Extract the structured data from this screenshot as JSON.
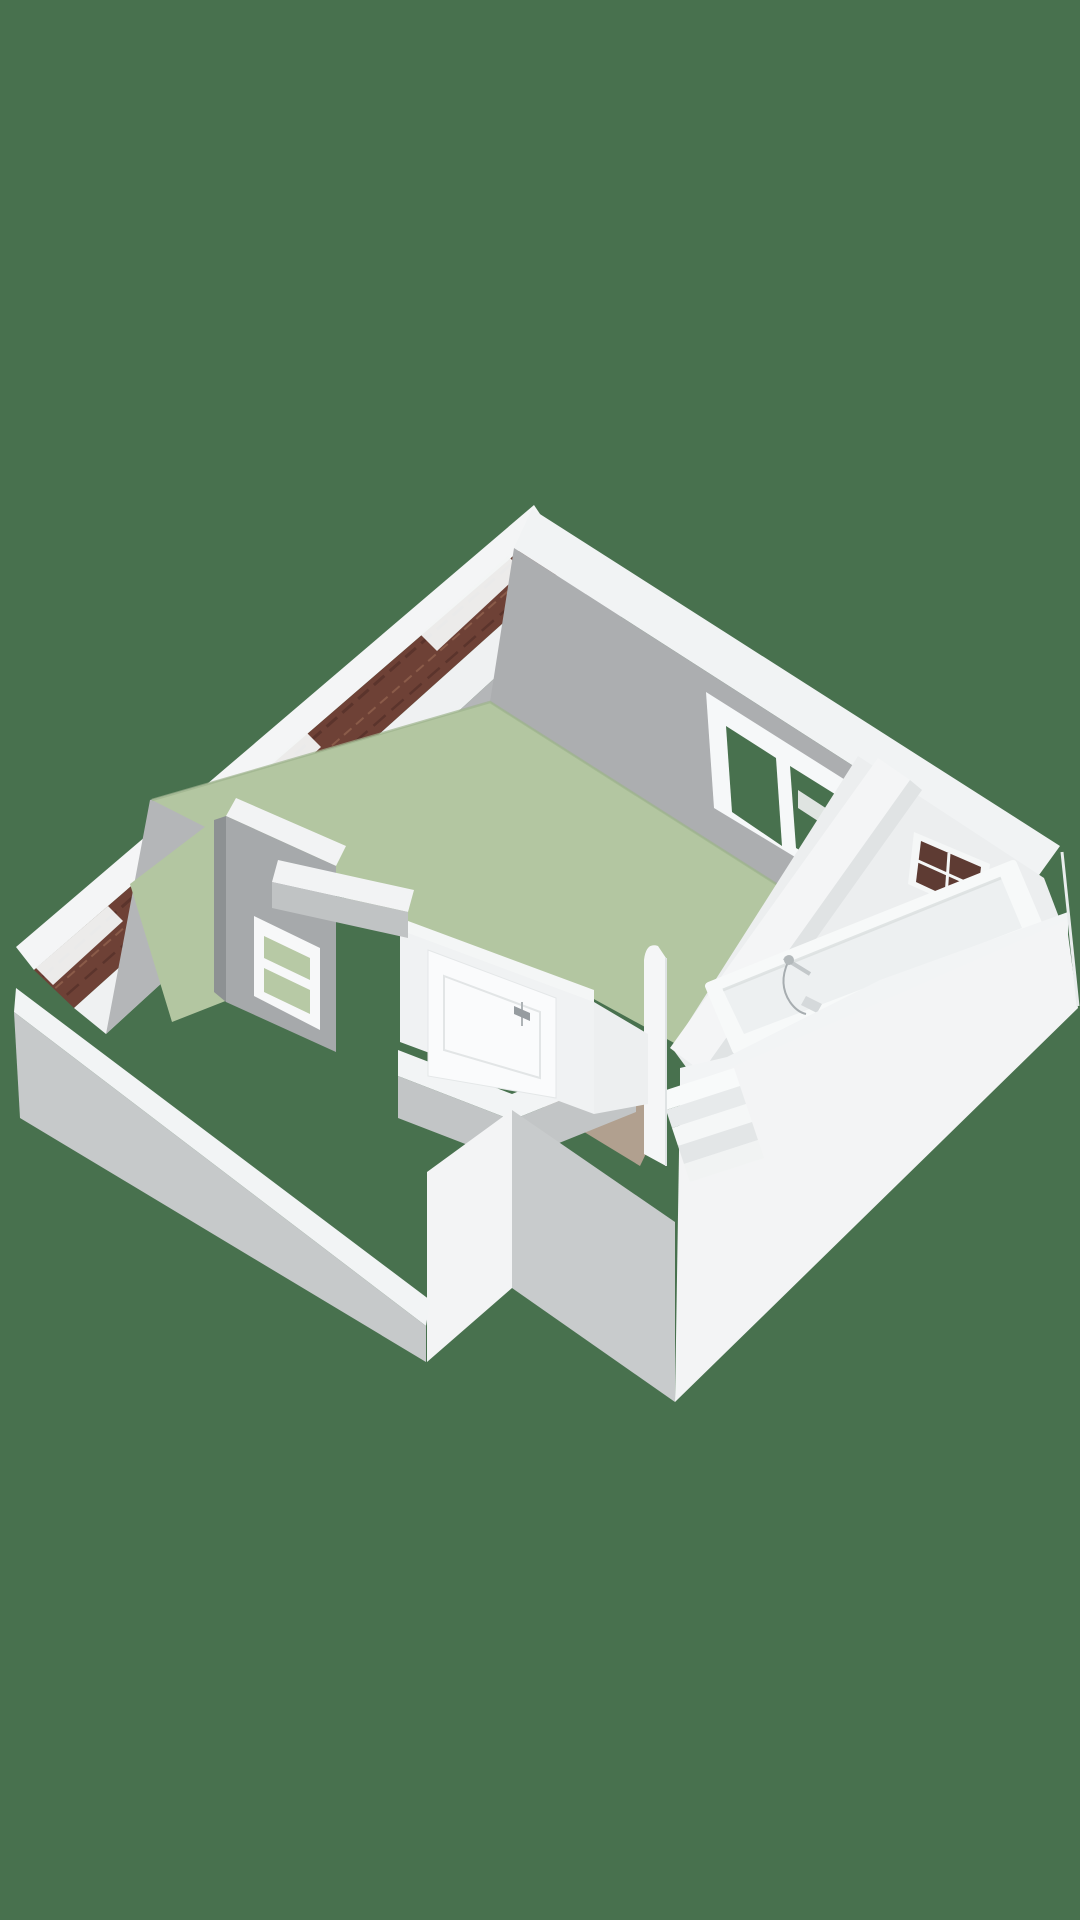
{
  "meta": {
    "title": "3D floor plan render - attic storey cutaway",
    "projection": "isometric-perspective dollhouse view",
    "background_color": "#48714E"
  },
  "colors": {
    "background": "#48714E",
    "bedroom_floor": "#B3C6A1",
    "floor_edge_shade": "#9EB38D",
    "hall_floor": "#B1A08F",
    "wall_white": "#F2F4F5",
    "wall_inner_gray": "#ACAEB0",
    "wall_outer_gray": "#C6C9CA",
    "roof_brick": "#6E4136",
    "roof_brick_dark": "#5B342C",
    "roof_brick_light": "#8A5B49",
    "fixture_white": "#F7F9F9",
    "fixture_inner": "#EDF0F1",
    "glass_exterior": "#48714E",
    "glass_interior_green": "#B7C9A5",
    "glass_dark_window": "#5E3B33",
    "chrome": "#A7ADB0"
  },
  "rooms": [
    {
      "id": "bedroom",
      "floor": "sage-green",
      "features": [
        "gable roof edge",
        "casement window",
        "interior borrowed-light window",
        "white panel door"
      ]
    },
    {
      "id": "bathroom",
      "floor": "light",
      "features": [
        "bathtub",
        "wall faucet with hand shower",
        "toilet",
        "small gridded window"
      ]
    },
    {
      "id": "hallway-landing",
      "floor": "tan",
      "features": [
        "door to bedroom",
        "stair opening"
      ]
    },
    {
      "id": "stairwell",
      "floor": "white steps",
      "features": [
        "winding stairs",
        "curved stair wall"
      ]
    }
  ],
  "scene": {
    "width": 1080,
    "height": 1920,
    "items": [
      {
        "n": "roof-ridge-band",
        "t": "p",
        "pts": "534,505 16,947 34,970 548,526",
        "f": "#F4F5F6"
      },
      {
        "n": "roof-brick-strip",
        "t": "p",
        "pts": "548,526 34,970 74,1008 580,554",
        "f": "#6E4136"
      },
      {
        "n": "roof-brick-row-line-1",
        "t": "pl",
        "pts": "542,537 40,979",
        "s": "#5B342C",
        "sw": 3,
        "dash": "14,7"
      },
      {
        "n": "roof-brick-row-line-2",
        "t": "pl",
        "pts": "556,549 52,991",
        "s": "#8A5B49",
        "sw": 2,
        "dash": "10,6"
      },
      {
        "n": "roof-brick-row-line-3",
        "t": "pl",
        "pts": "566,557 62,999",
        "s": "#5B342C",
        "sw": 2.5,
        "dash": "16,8"
      },
      {
        "n": "roof-flashing-1",
        "t": "p",
        "pts": "508,556 420,634 437,651 523,571",
        "f": "#F2F4F4",
        "o": 0.95
      },
      {
        "n": "roof-flashing-2",
        "t": "p",
        "pts": "306,732 218,810 235,827 321,747",
        "f": "#F2F4F4",
        "o": 0.95
      },
      {
        "n": "roof-flashing-3",
        "t": "p",
        "pts": "108,906 36,968 53,985 123,921",
        "f": "#F2F4F4",
        "o": 0.95
      },
      {
        "n": "gable-wall-top-band",
        "t": "p",
        "pts": "580,554 74,1008 106,1034 604,578",
        "f": "#EFF1F2"
      },
      {
        "n": "gable-wall-inner-face",
        "t": "p",
        "pts": "604,578 640,660 150,800 106,1034",
        "f": "#B4B6B8"
      },
      {
        "n": "ne-wall-top-band",
        "t": "p",
        "pts": "532,509 1060,846 1034,882 514,548",
        "f": "#F1F3F4"
      },
      {
        "n": "ne-wall-inner-face",
        "t": "p",
        "pts": "514,548 1034,882 992,934 858,936 490,702",
        "f": "#ACAEB0"
      },
      {
        "n": "bedroom-floor",
        "t": "p",
        "pts": "490,702 858,936 676,1044 592,998 404,928 286,868 152,800",
        "f": "#B3C6A1"
      },
      {
        "n": "bedroom-floor-edge-shadow",
        "t": "pl",
        "pts": "152,800 490,702 858,936",
        "s": "#9EB38D",
        "sw": 2.5,
        "o": 0.7
      },
      {
        "n": "bedroom-floor-west-sliver",
        "t": "p",
        "pts": "214,820 228,1000 172,1022 130,884",
        "f": "#B3C6A1"
      },
      {
        "n": "storage-wall-top-band",
        "t": "p",
        "pts": "236,798 346,846 336,866 226,816",
        "f": "#F2F3F4"
      },
      {
        "n": "storage-wall-face",
        "t": "p",
        "pts": "226,816 336,866 336,1052 226,1002",
        "f": "#A6A9AB"
      },
      {
        "n": "storage-wall-edge",
        "t": "p",
        "pts": "214,820 226,816 226,1002 214,992",
        "f": "#8D9193"
      },
      {
        "n": "interior-window-frame",
        "t": "p",
        "pts": "254,916 320,948 320,1030 254,996",
        "f": "#F7F8F9"
      },
      {
        "n": "interior-window-pane-upper",
        "t": "p",
        "pts": "264,936 310,958 310,980 264,958",
        "f": "#B7C9A5"
      },
      {
        "n": "interior-window-pane-lower",
        "t": "p",
        "pts": "264,968 310,990 310,1014 264,992",
        "f": "#B7C9A5"
      },
      {
        "n": "bedroom-window-frame",
        "t": "p",
        "pts": "706,692 858,788 866,900 714,808",
        "f": "#F6F8F9"
      },
      {
        "n": "bedroom-window-pane-left",
        "t": "p",
        "pts": "726,726 776,758 782,846 732,812",
        "f": "#48714E"
      },
      {
        "n": "bedroom-window-pane-right",
        "t": "p",
        "pts": "790,766 838,796 844,876 796,848",
        "f": "#48714E"
      },
      {
        "n": "bedroom-window-through-wall-band",
        "t": "p",
        "pts": "798,790 838,816 838,834 798,808",
        "f": "#EFF1F2",
        "o": 0.9
      },
      {
        "n": "bathroom-interior",
        "t": "p",
        "pts": "858,756 1044,878 1060,920 992,952 700,1086 672,1048",
        "f": "#ECEEEF"
      },
      {
        "n": "bathroom-window-frame",
        "t": "p",
        "pts": "914,832 990,864 984,918 908,884",
        "f": "#F5F7F7"
      },
      {
        "n": "bathroom-window-glass",
        "t": "p",
        "pts": "921,841 981,867 976,910 916,882",
        "f": "#5E3B33"
      },
      {
        "n": "bathroom-window-bar-horizontal",
        "t": "pl",
        "pts": "918,861 978,888",
        "s": "#F5F7F7",
        "sw": 3
      },
      {
        "n": "bathroom-window-bar-vertical",
        "t": "pl",
        "pts": "949,853 946,897",
        "s": "#F5F7F7",
        "sw": 3
      },
      {
        "n": "toilet-tank",
        "t": "p",
        "pts": "716,1022 764,1002 778,1028 730,1048",
        "f": "#F4F6F6"
      },
      {
        "n": "toilet-tank-inner",
        "t": "p",
        "pts": "724,1024 758,1010 766,1026 732,1040",
        "f": "#DFE3E4"
      },
      {
        "n": "toilet-bowl",
        "t": "p",
        "pts": "692,1040 734,1022 750,1046 708,1066",
        "f": "#F7F9F9",
        "s": "#F7F9F9",
        "sw": 6,
        "rj": 1
      },
      {
        "n": "toilet-bowl-inner",
        "t": "p",
        "pts": "704,1044 732,1032 740,1048 712,1060",
        "f": "#DDE1E2"
      },
      {
        "n": "partition-wall-top-band",
        "t": "p",
        "pts": "878,758 910,780 702,1072 670,1048",
        "f": "#F4F5F6"
      },
      {
        "n": "partition-wall-shade",
        "t": "p",
        "pts": "910,780 922,790 714,1082 702,1072",
        "f": "#E0E3E4"
      },
      {
        "n": "bathtub-rim",
        "t": "p",
        "pts": "709,986 1013,864 1040,928 736,1050",
        "f": "#F7F9F9",
        "s": "#F7F9F9",
        "sw": 8,
        "rj": 1
      },
      {
        "n": "bathtub-basin",
        "t": "p",
        "pts": "723,990 1001,878 1022,928 744,1034",
        "f": "#EDF0F1"
      },
      {
        "n": "bathtub-basin-shadow",
        "t": "pl",
        "pts": "723,990 1001,878",
        "s": "#D9DEDF",
        "sw": 3,
        "o": 0.8
      },
      {
        "n": "faucet-bar",
        "t": "pl",
        "pts": "784,958 810,974",
        "s": "#C3C8CA",
        "sw": 4
      },
      {
        "n": "faucet-hose",
        "t": "pa",
        "d": "M788,962 Q778,984 790,1002 Q797,1012 806,1014",
        "s": "#A7ADB0",
        "sw": 2,
        "f": "none"
      },
      {
        "n": "shower-head",
        "t": "e",
        "cx": 789,
        "cy": 960,
        "rx": 5,
        "ry": 5,
        "f": "#B3B9BB"
      },
      {
        "n": "faucet-spout",
        "t": "p",
        "pts": "806,996 822,1004 817,1013 801,1005",
        "f": "#D5D9DB"
      },
      {
        "n": "se-wall-top-band",
        "t": "p",
        "pts": "1068,912 880,980 727,1057 680,1068 680,1096 727,1085 880,1008 1068,938",
        "f": "#F2F4F5"
      },
      {
        "n": "se-outer-wall-face",
        "t": "p",
        "pts": "1066,920 1078,1008 675,1402 680,1090",
        "f": "#F3F4F5"
      },
      {
        "n": "se-corner-arris",
        "t": "pl",
        "pts": "1062,852 1078,1006",
        "s": "#E9ECED",
        "sw": 3
      },
      {
        "n": "hall-floor",
        "t": "p",
        "pts": "545,1040 668,1108 640,1166 535,1102",
        "f": "#B1A08F"
      },
      {
        "n": "hall-floor-door-sliver",
        "t": "p",
        "pts": "416,1086 450,1102 438,1130 408,1114",
        "f": "#B1A08F"
      },
      {
        "n": "stair-step-1",
        "t": "p",
        "pts": "660,1092 734,1068 740,1086 666,1110",
        "f": "#F8FAFA"
      },
      {
        "n": "stair-step-2",
        "t": "p",
        "pts": "666,1110 740,1086 746,1104 672,1128",
        "f": "#E7EAEB"
      },
      {
        "n": "stair-step-3",
        "t": "p",
        "pts": "672,1128 746,1104 752,1122 678,1146",
        "f": "#F5F7F7"
      },
      {
        "n": "stair-step-4",
        "t": "p",
        "pts": "678,1146 752,1122 758,1140 684,1164",
        "f": "#E3E6E7"
      },
      {
        "n": "stair-step-5",
        "t": "p",
        "pts": "684,1164 758,1140 764,1158 690,1182",
        "f": "#F1F3F3"
      },
      {
        "n": "stairwell-curved-wall",
        "t": "pa",
        "d": "M644,1154 L644,960 Q646,942 658,946 L666,958 L666,1166 Z",
        "f": "#F5F6F7"
      },
      {
        "n": "stairwell-curved-wall-edge",
        "t": "pl",
        "pts": "666,958 666,1166",
        "s": "#DFE3E4",
        "sw": 2
      },
      {
        "n": "front-notch-band-left",
        "t": "p",
        "pts": "398,1050 512,1094 512,1120 398,1076",
        "f": "#F2F4F5"
      },
      {
        "n": "front-notch-band-right",
        "t": "p",
        "pts": "512,1094 636,1044 636,1070 512,1120",
        "f": "#F2F4F5"
      },
      {
        "n": "front-notch-underface-left",
        "t": "p",
        "pts": "398,1076 512,1120 512,1162 398,1118",
        "f": "#C2C5C6"
      },
      {
        "n": "front-notch-underface-right",
        "t": "p",
        "pts": "512,1120 636,1070 636,1112 512,1162",
        "f": "#C2C5C6"
      },
      {
        "n": "notch-white-face",
        "t": "p",
        "pts": "427,1172 512,1110 512,1288 427,1362",
        "f": "#F3F4F5"
      },
      {
        "n": "stairwell-bump-gray-face",
        "t": "p",
        "pts": "512,1110 675,1222 675,1402 512,1288",
        "f": "#C8CBCC"
      },
      {
        "n": "sw-wall-top-band",
        "t": "p",
        "pts": "16,988 430,1300 426,1326 14,1012",
        "f": "#F2F4F5"
      },
      {
        "n": "sw-outer-wall-face",
        "t": "p",
        "pts": "14,1012 426,1326 426,1362 20,1118",
        "f": "#C6C9CA"
      },
      {
        "n": "doorwall-top-band",
        "t": "p",
        "pts": "400,918 594,990 594,1004 400,932",
        "f": "#F4F6F6"
      },
      {
        "n": "door-wall",
        "t": "p",
        "pts": "400,930 594,1002 594,1114 400,1042",
        "f": "#F0F2F3"
      },
      {
        "n": "bedroom-door",
        "t": "p",
        "pts": "428,950 556,998 556,1098 428,1076",
        "f": "#FAFBFC",
        "s": "#E4E7E8",
        "sw": 1
      },
      {
        "n": "bedroom-door-panel",
        "t": "p",
        "pts": "444,976 540,1012 540,1078 444,1050",
        "f": "none",
        "s": "#E2E5E6",
        "sw": 2
      },
      {
        "n": "door-handle-plate",
        "t": "pl",
        "pts": "522,1002 522,1026",
        "s": "#AEB3B6",
        "sw": 2
      },
      {
        "n": "door-handle",
        "t": "p",
        "pts": "514,1006 530,1013 530,1021 514,1014",
        "f": "#969CA0"
      },
      {
        "n": "hallwall-west-band",
        "t": "p",
        "pts": "278,860 414,890 408,912 272,882",
        "f": "#F2F3F4"
      },
      {
        "n": "hallwall-west-face",
        "t": "p",
        "pts": "272,882 408,912 408,938 272,908",
        "f": "#C0C3C4"
      },
      {
        "n": "hall-east-face",
        "t": "p",
        "pts": "594,1002 648,1034 648,1104 594,1114",
        "f": "#EDEFF0"
      }
    ]
  }
}
